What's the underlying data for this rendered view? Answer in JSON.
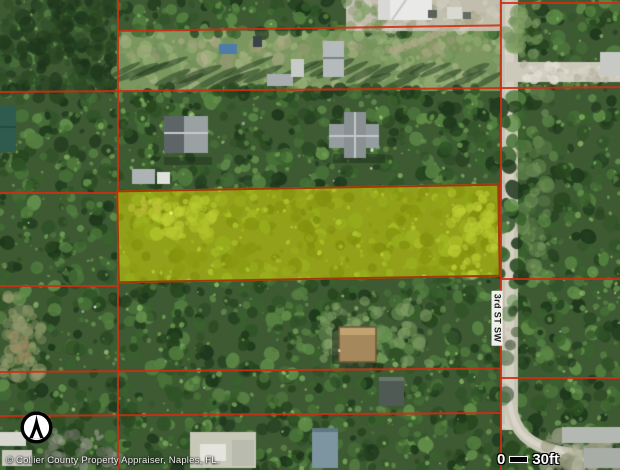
{
  "map": {
    "title": "Aerial parcel map",
    "street_label": "3rd ST SW",
    "attribution": "© Collier County Property Appraiser, Naples, FL.",
    "scale": {
      "start": "0",
      "end": "30ft"
    },
    "colors": {
      "parcel_line": "#cf2d12",
      "subject_fill": "rgba(232,232,0,0.5)",
      "subject_outline": "#a03c0a"
    },
    "compass_icon": "north-arrow"
  }
}
